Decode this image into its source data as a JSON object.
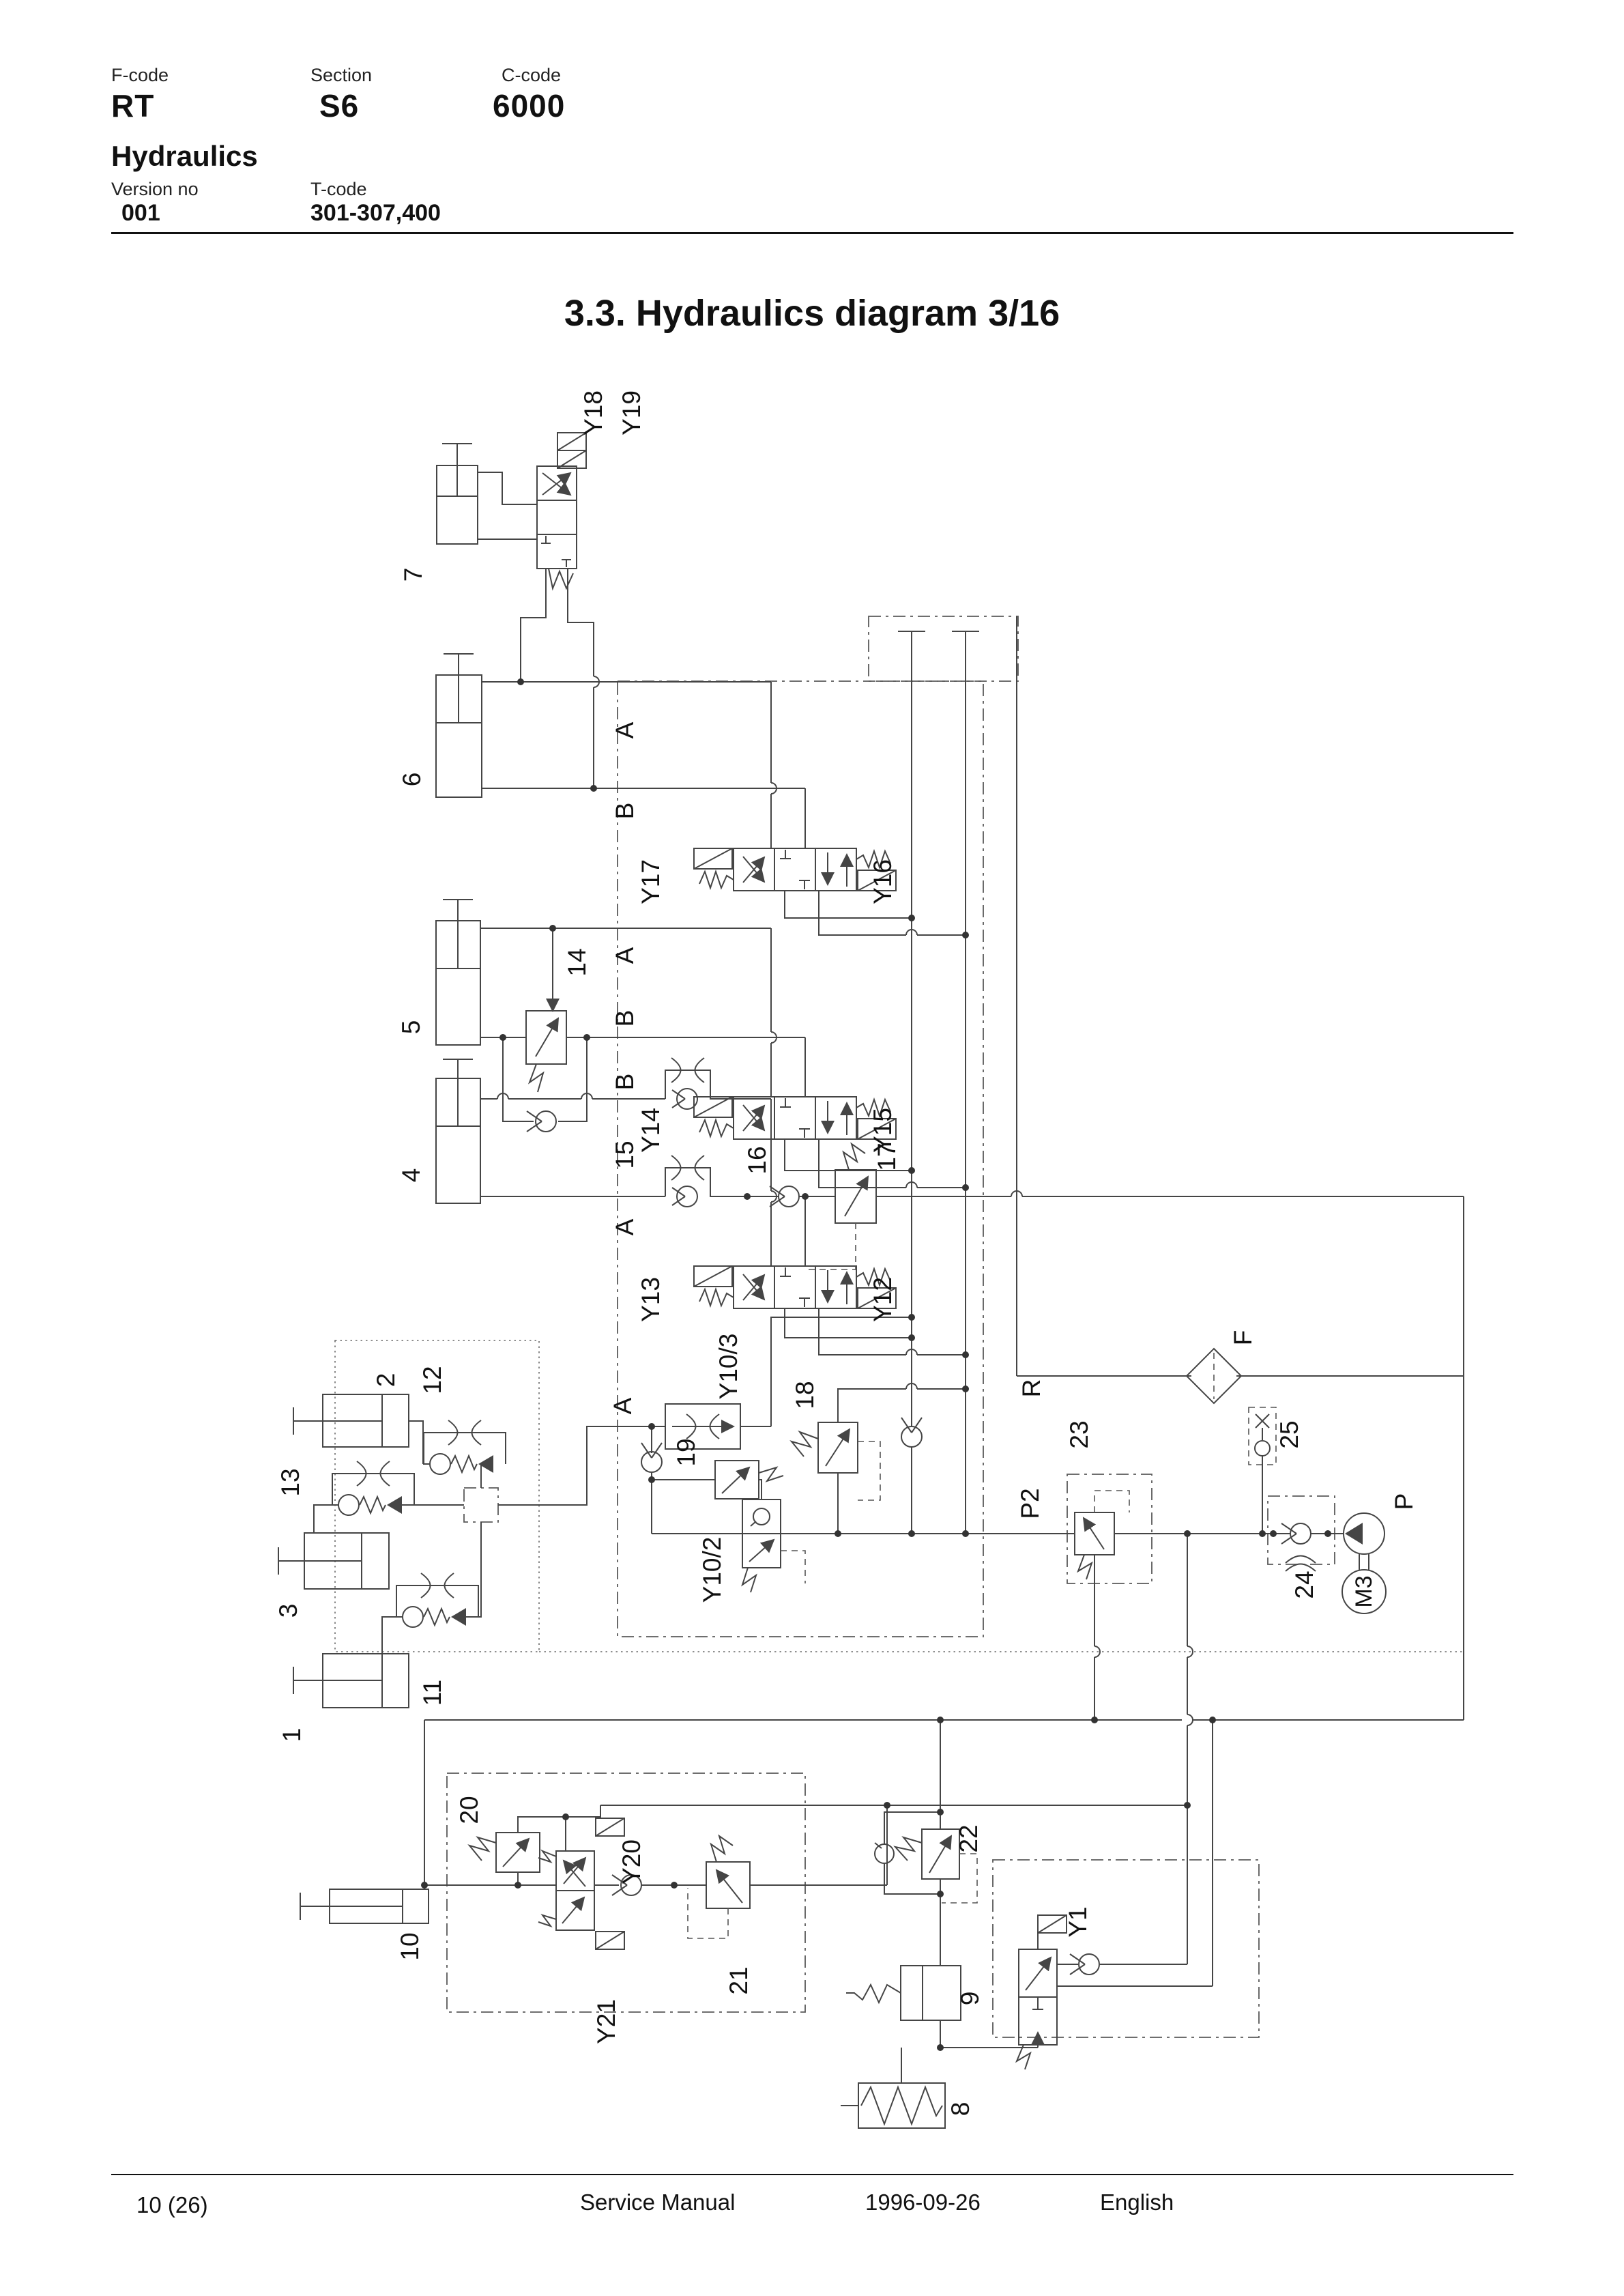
{
  "header": {
    "f_code_label": "F-code",
    "f_code": "RT",
    "section_label": "Section",
    "section": "S6",
    "c_code_label": "C-code",
    "c_code": "6000",
    "subtitle": "Hydraulics",
    "version_label": "Version no",
    "version": "001",
    "t_code_label": "T-code",
    "t_code": "301-307,400"
  },
  "title": "3.3. Hydraulics diagram 3/16",
  "footer": {
    "page": "10 (26)",
    "doc": "Service Manual",
    "date": "1996-09-26",
    "lang": "English"
  },
  "diagram": {
    "labels": {
      "y18": "Y18",
      "y19": "Y19",
      "c7": "7",
      "c6": "6",
      "c5": "5",
      "c4": "4",
      "port_a": "A",
      "port_b": "B",
      "y17": "Y17",
      "y16": "Y16",
      "y14": "Y14",
      "y15": "Y15",
      "y13": "Y13",
      "y12": "Y12",
      "n14": "14",
      "n15": "15",
      "n16": "16",
      "n17": "17",
      "c1": "1",
      "c2": "2",
      "c3": "3",
      "n11": "11",
      "n12": "12",
      "n13": "13",
      "y10_3": "Y10/3",
      "y10_2": "Y10/2",
      "n18": "18",
      "n19": "19",
      "r": "R",
      "p2": "P2",
      "p": "P",
      "n23": "23",
      "n24": "24",
      "n25": "25",
      "f": "F",
      "m3": "M3",
      "c10": "10",
      "n20": "20",
      "n21": "21",
      "n22": "22",
      "y20": "Y20",
      "y21": "Y21",
      "y1": "Y1",
      "n8": "8",
      "n9": "9"
    }
  }
}
